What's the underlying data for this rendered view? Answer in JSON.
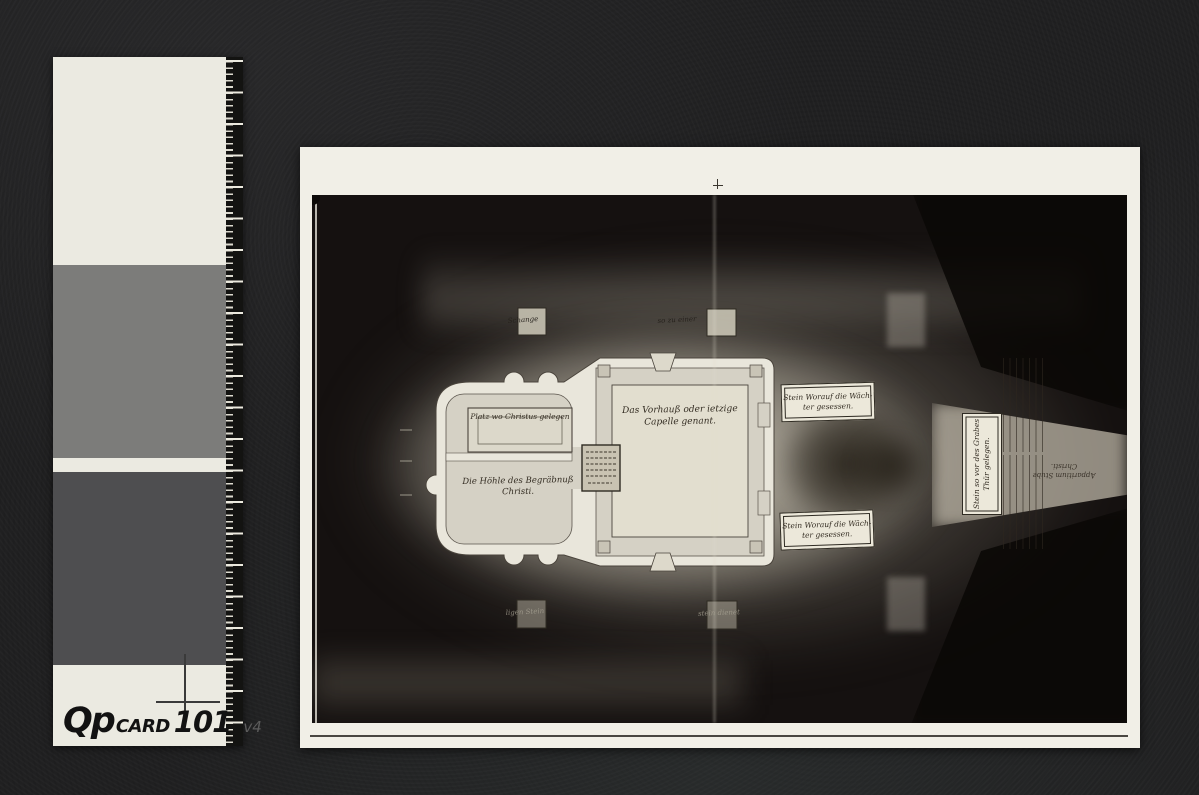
{
  "calibration_card": {
    "logo": {
      "q": "Q",
      "p": "p",
      "card": "CARD",
      "number": "101",
      "version": "v4"
    },
    "patch_colors": {
      "card_white": "#ebeae1",
      "patch_mid": "#7c7c7a",
      "patch_dark": "#4e4e50"
    }
  },
  "photo": {
    "paper_color": "#f1efe7",
    "plan": {
      "tomb_slab": "Platz wo Christus gelegen",
      "burial_cave_line1": "Die Höhle des Begräbnuß",
      "burial_cave_line2": "Christi.",
      "chapel_line1": "Das Vorhauß oder ietzige",
      "chapel_line2": "Capelle genant.",
      "guard_stone_top_line1": "Stein Worauf die Wäch-",
      "guard_stone_top_line2": "ter gesessen.",
      "guard_stone_bottom_line1": "Stein Worauf die Wäch-",
      "guard_stone_bottom_line2": "ter gesessen.",
      "door_stone_line1": "Stein so vor des Grabes",
      "door_stone_line2": "Thür gelegen.",
      "apparition_line1": "Apparitium Stube",
      "apparition_line2": "Christi.",
      "marker_top_left": "Schange",
      "marker_top_right": "so zu einer",
      "marker_bottom_left": "ligen Stein",
      "marker_bottom_right": "stein dienet"
    }
  }
}
